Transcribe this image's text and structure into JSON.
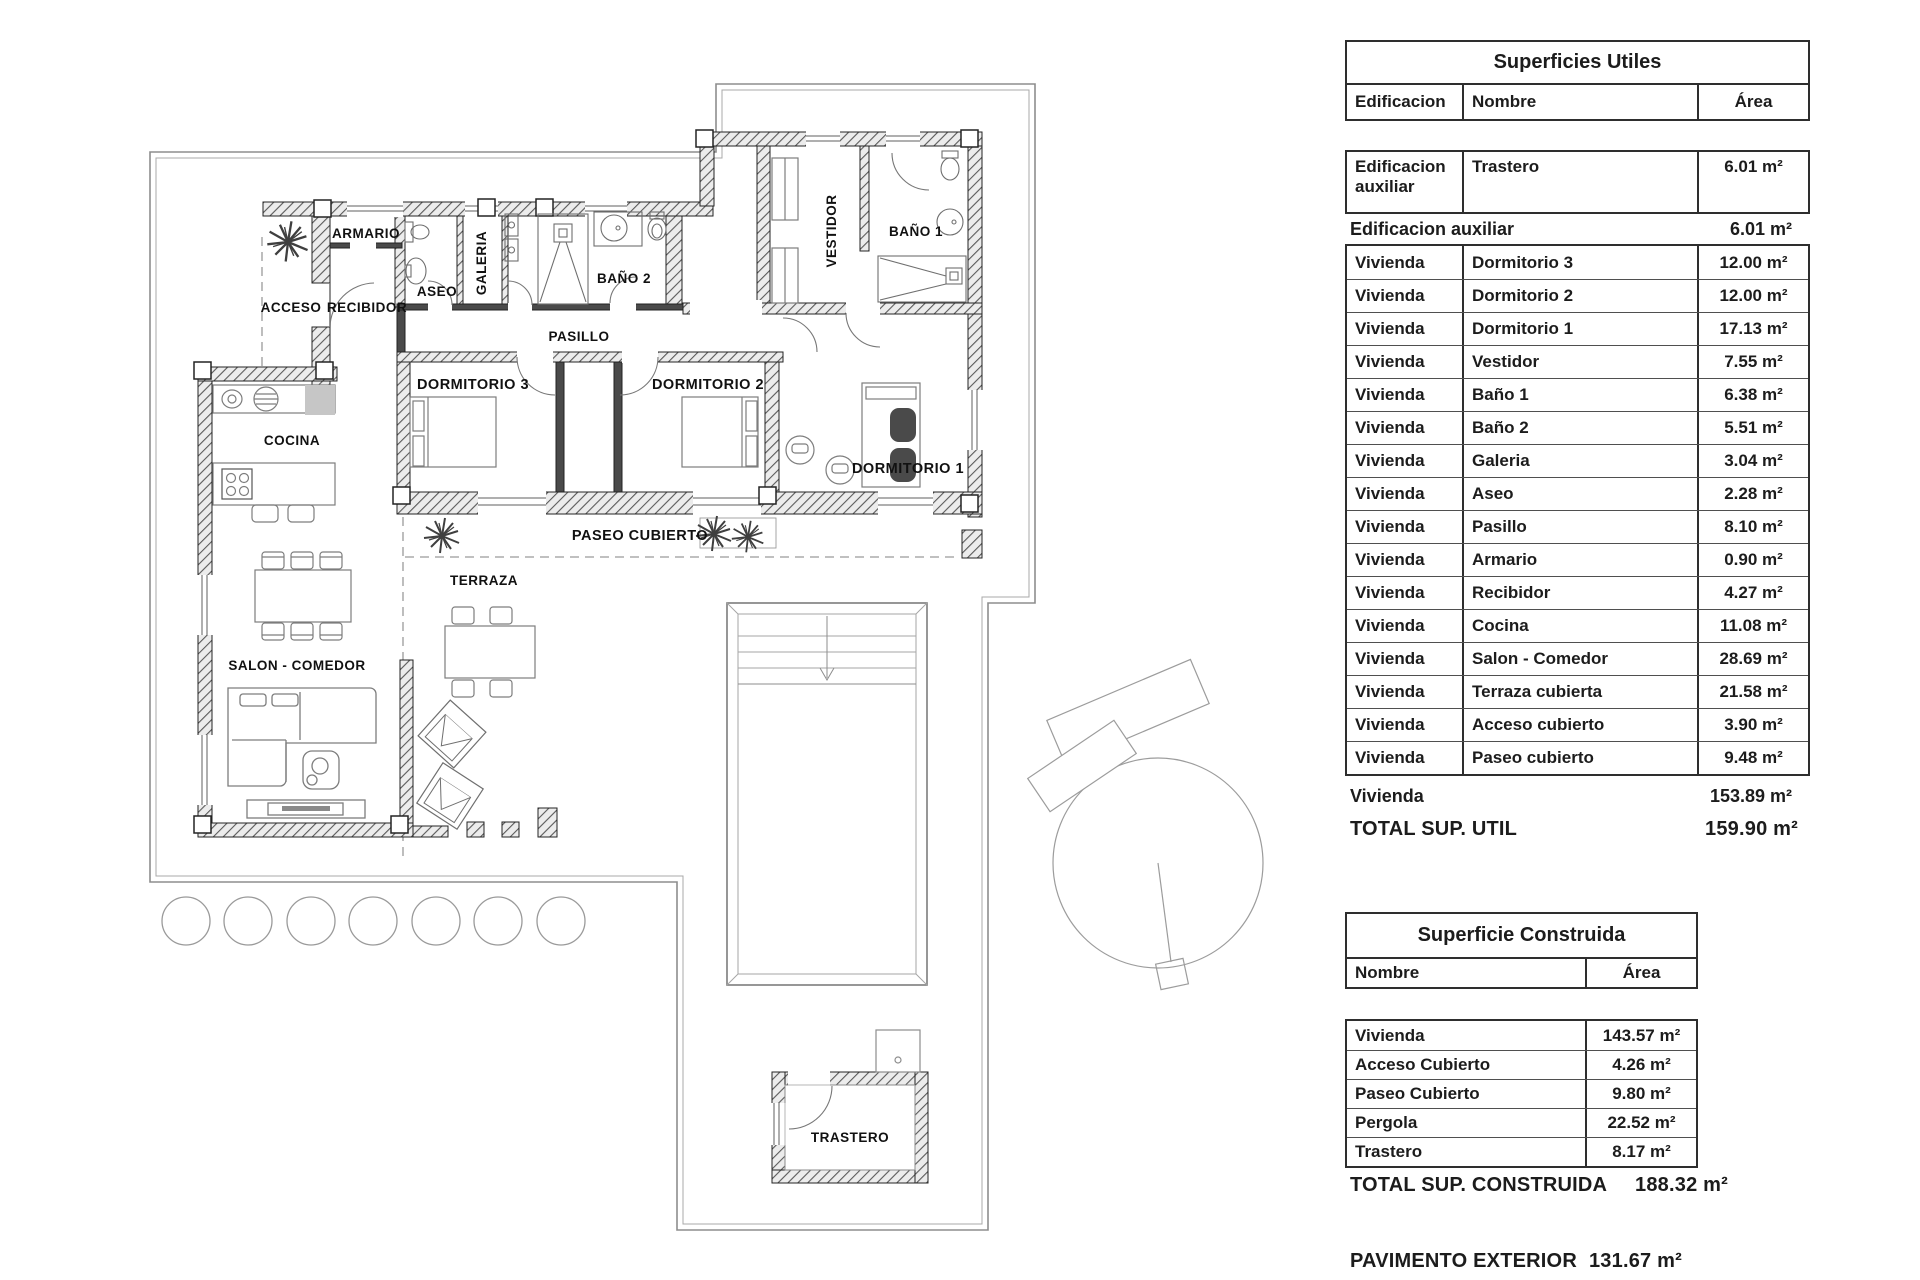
{
  "plan": {
    "labels": {
      "armario": "ARMARIO",
      "acceso": "ACCESO",
      "recibidor": "RECIBIDOR",
      "aseo": "ASEO",
      "galeria": "GALERIA",
      "bano2": "BAÑO 2",
      "pasillo": "PASILLO",
      "vestidor": "VESTIDOR",
      "bano1": "BAÑO 1",
      "dormitorio3": "DORMITORIO 3",
      "dormitorio2": "DORMITORIO 2",
      "dormitorio1": "DORMITORIO 1",
      "cocina": "COCINA",
      "salon": "SALON - COMEDOR",
      "terraza": "TERRAZA",
      "paseo": "PASEO CUBIERTO",
      "trastero": "TRASTERO"
    }
  },
  "tables": {
    "superficies_utiles": {
      "title": "Superficies Utiles",
      "col_edificacion": "Edificacion",
      "col_nombre": "Nombre",
      "col_area": "Área",
      "aux_row": {
        "edificacion": "Edificacion auxiliar",
        "nombre": "Trastero",
        "area": "6.01 m²"
      },
      "aux_total": {
        "label": "Edificacion auxiliar",
        "value": "6.01 m²"
      },
      "rows": [
        {
          "edificacion": "Vivienda",
          "nombre": "Dormitorio 3",
          "area": "12.00 m²"
        },
        {
          "edificacion": "Vivienda",
          "nombre": "Dormitorio 2",
          "area": "12.00 m²"
        },
        {
          "edificacion": "Vivienda",
          "nombre": "Dormitorio 1",
          "area": "17.13 m²"
        },
        {
          "edificacion": "Vivienda",
          "nombre": "Vestidor",
          "area": "7.55 m²"
        },
        {
          "edificacion": "Vivienda",
          "nombre": "Baño 1",
          "area": "6.38 m²"
        },
        {
          "edificacion": "Vivienda",
          "nombre": "Baño 2",
          "area": "5.51 m²"
        },
        {
          "edificacion": "Vivienda",
          "nombre": "Galeria",
          "area": "3.04 m²"
        },
        {
          "edificacion": "Vivienda",
          "nombre": "Aseo",
          "area": "2.28 m²"
        },
        {
          "edificacion": "Vivienda",
          "nombre": "Pasillo",
          "area": "8.10 m²"
        },
        {
          "edificacion": "Vivienda",
          "nombre": "Armario",
          "area": "0.90 m²"
        },
        {
          "edificacion": "Vivienda",
          "nombre": "Recibidor",
          "area": "4.27 m²"
        },
        {
          "edificacion": "Vivienda",
          "nombre": "Cocina",
          "area": "11.08 m²"
        },
        {
          "edificacion": "Vivienda",
          "nombre": "Salon - Comedor",
          "area": "28.69 m²"
        },
        {
          "edificacion": "Vivienda",
          "nombre": "Terraza cubierta",
          "area": "21.58 m²"
        },
        {
          "edificacion": "Vivienda",
          "nombre": "Acceso cubierto",
          "area": "3.90 m²"
        },
        {
          "edificacion": "Vivienda",
          "nombre": "Paseo cubierto",
          "area": "9.48 m²"
        }
      ],
      "vivienda_total": {
        "label": "Vivienda",
        "value": "153.89 m²"
      },
      "total": {
        "label": "TOTAL SUP. UTIL",
        "value": "159.90 m²"
      }
    },
    "superficie_construida": {
      "title": "Superficie Construida",
      "col_nombre": "Nombre",
      "col_area": "Área",
      "rows": [
        {
          "nombre": "Vivienda",
          "area": "143.57 m²"
        },
        {
          "nombre": "Acceso Cubierto",
          "area": "4.26 m²"
        },
        {
          "nombre": "Paseo Cubierto",
          "area": "9.80 m²"
        },
        {
          "nombre": "Pergola",
          "area": "22.52 m²"
        },
        {
          "nombre": "Trastero",
          "area": "8.17 m²"
        }
      ],
      "total": {
        "label": "TOTAL SUP. CONSTRUIDA",
        "value": "188.32 m²"
      },
      "pavimento": {
        "label": "PAVIMENTO EXTERIOR",
        "value": "131.67 m²"
      }
    }
  }
}
